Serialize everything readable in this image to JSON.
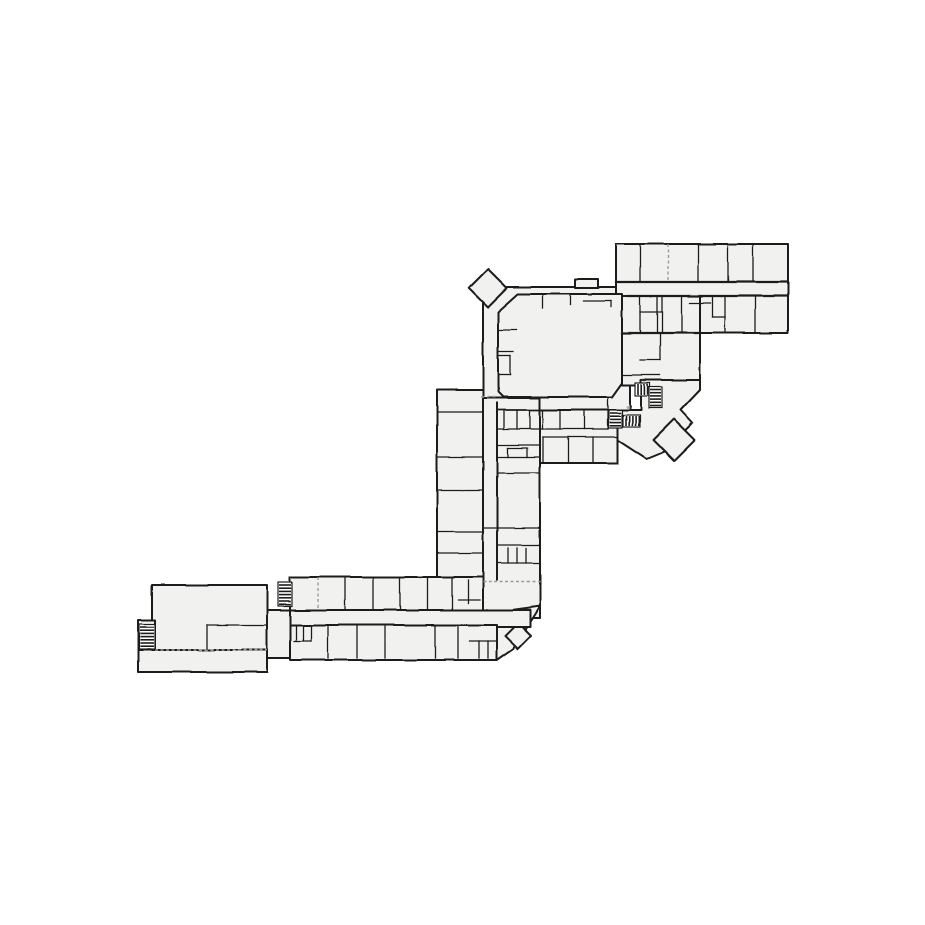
{
  "drawing": {
    "title": "building-floor-plan",
    "canvas": {
      "width": 925,
      "height": 925,
      "background": "#ffffff"
    },
    "style": {
      "room_fill": "#f1f1f0",
      "wall_color": "#1f1f1f",
      "outer_width": 2.0,
      "inner_width": 1.3,
      "dash_color": "#9a9a9a",
      "label_color": "#444444"
    },
    "blocks": [
      {
        "name": "hall-block",
        "points": [
          [
            483,
            287
          ],
          [
            630,
            287
          ],
          [
            630,
            412
          ],
          [
            483,
            412
          ]
        ]
      },
      {
        "name": "hall-top-bump",
        "points": [
          [
            575,
            279
          ],
          [
            598,
            279
          ],
          [
            598,
            288
          ],
          [
            575,
            288
          ]
        ]
      },
      {
        "name": "entry-vestibule",
        "points": [
          [
            488,
            269
          ],
          [
            507,
            288
          ],
          [
            488,
            307
          ],
          [
            469,
            288
          ]
        ]
      },
      {
        "name": "top-right-wing",
        "points": [
          [
            616,
            244
          ],
          [
            788,
            244
          ],
          [
            788,
            333
          ],
          [
            616,
            333
          ]
        ]
      },
      {
        "name": "right-mid-block",
        "points": [
          [
            622,
            296
          ],
          [
            700,
            296
          ],
          [
            700,
            385
          ],
          [
            622,
            385
          ]
        ]
      },
      {
        "name": "lobby",
        "points": [
          [
            604,
            410
          ],
          [
            641,
            410
          ],
          [
            641,
            380
          ],
          [
            700,
            380
          ],
          [
            700,
            390
          ],
          [
            681,
            410
          ],
          [
            693,
            423
          ],
          [
            664,
            452
          ],
          [
            647,
            459
          ],
          [
            604,
            431
          ]
        ]
      },
      {
        "name": "lobby-diamond-room",
        "points": [
          [
            674,
            419
          ],
          [
            695,
            440
          ],
          [
            674,
            461
          ],
          [
            653,
            440
          ]
        ]
      },
      {
        "name": "rooms-below-hall",
        "points": [
          [
            497,
            410
          ],
          [
            618,
            410
          ],
          [
            618,
            463
          ],
          [
            497,
            463
          ]
        ]
      },
      {
        "name": "mid-left-room-column",
        "points": [
          [
            437,
            390
          ],
          [
            483,
            390
          ],
          [
            483,
            577
          ],
          [
            437,
            577
          ]
        ]
      },
      {
        "name": "mid-corridor-block",
        "points": [
          [
            483,
            398
          ],
          [
            540,
            398
          ],
          [
            540,
            618
          ],
          [
            483,
            618
          ]
        ]
      },
      {
        "name": "south-junction",
        "points": [
          [
            483,
            614
          ],
          [
            540,
            606
          ],
          [
            513,
            649
          ],
          [
            497,
            660
          ],
          [
            483,
            660
          ]
        ]
      },
      {
        "name": "junction-diamond-room",
        "points": [
          [
            518,
            623
          ],
          [
            531,
            636
          ],
          [
            518,
            649
          ],
          [
            505,
            636
          ]
        ]
      },
      {
        "name": "southwest-upper-row",
        "points": [
          [
            290,
            577
          ],
          [
            483,
            577
          ],
          [
            483,
            612
          ],
          [
            290,
            612
          ]
        ]
      },
      {
        "name": "southwest-corridor",
        "points": [
          [
            267,
            610
          ],
          [
            530,
            610
          ],
          [
            530,
            627
          ],
          [
            267,
            627
          ]
        ]
      },
      {
        "name": "southwest-lower-row",
        "points": [
          [
            290,
            625
          ],
          [
            497,
            625
          ],
          [
            497,
            660
          ],
          [
            290,
            660
          ]
        ]
      },
      {
        "name": "west-passage",
        "points": [
          [
            267,
            610
          ],
          [
            290,
            610
          ],
          [
            290,
            658
          ],
          [
            267,
            658
          ]
        ]
      },
      {
        "name": "west-large-room",
        "points": [
          [
            152,
            585
          ],
          [
            267,
            585
          ],
          [
            267,
            650
          ],
          [
            152,
            650
          ]
        ]
      },
      {
        "name": "west-lower-strip",
        "points": [
          [
            138,
            650
          ],
          [
            267,
            650
          ],
          [
            267,
            672
          ],
          [
            138,
            672
          ]
        ]
      },
      {
        "name": "west-stair-bay",
        "points": [
          [
            138,
            620
          ],
          [
            155,
            620
          ],
          [
            155,
            650
          ],
          [
            138,
            650
          ]
        ]
      },
      {
        "name": "hall-room",
        "points": [
          [
            498,
            312
          ],
          [
            518,
            294
          ],
          [
            622,
            294
          ],
          [
            622,
            383
          ],
          [
            612,
            397
          ],
          [
            503,
            397
          ],
          [
            498,
            392
          ]
        ]
      }
    ],
    "walls": [
      [
        616,
        282,
        788,
        282,
        2.2
      ],
      [
        628,
        296,
        788,
        296,
        2.2
      ],
      [
        622,
        333,
        700,
        333,
        2.2
      ],
      [
        497,
        403,
        497,
        580,
        2.0
      ],
      [
        640,
        244,
        640,
        282
      ],
      [
        698,
        244,
        698,
        282
      ],
      [
        728,
        244,
        728,
        282
      ],
      [
        753,
        244,
        753,
        282
      ],
      [
        657,
        296,
        657,
        333
      ],
      [
        682,
        296,
        682,
        333
      ],
      [
        712,
        296,
        712,
        317
      ],
      [
        712,
        317,
        725,
        317
      ],
      [
        725,
        296,
        725,
        333
      ],
      [
        755,
        296,
        755,
        333
      ],
      [
        690,
        303,
        710,
        303
      ],
      [
        640,
        296,
        640,
        333
      ],
      [
        662,
        296,
        662,
        333
      ],
      [
        640,
        312,
        662,
        312
      ],
      [
        640,
        360,
        660,
        360
      ],
      [
        660,
        333,
        660,
        360
      ],
      [
        622,
        375,
        660,
        375
      ],
      [
        641,
        385,
        641,
        410
      ],
      [
        543,
        294,
        543,
        308
      ],
      [
        570,
        294,
        570,
        305
      ],
      [
        583,
        301,
        611,
        301
      ],
      [
        611,
        301,
        611,
        307
      ],
      [
        498,
        330,
        516,
        330
      ],
      [
        498,
        352,
        513,
        352
      ],
      [
        498,
        356,
        510,
        356
      ],
      [
        510,
        356,
        510,
        375
      ],
      [
        498,
        375,
        510,
        375
      ],
      [
        437,
        412,
        483,
        412
      ],
      [
        437,
        457,
        483,
        457
      ],
      [
        437,
        490,
        483,
        490
      ],
      [
        437,
        532,
        483,
        532
      ],
      [
        437,
        553,
        483,
        553
      ],
      [
        497,
        445,
        540,
        445
      ],
      [
        508,
        448,
        508,
        457
      ],
      [
        527,
        448,
        527,
        457
      ],
      [
        508,
        448,
        527,
        448
      ],
      [
        497,
        457,
        540,
        457
      ],
      [
        497,
        473,
        540,
        473
      ],
      [
        483,
        528,
        540,
        528
      ],
      [
        497,
        545,
        540,
        545
      ],
      [
        508,
        548,
        508,
        563
      ],
      [
        517,
        548,
        517,
        563
      ],
      [
        526,
        548,
        526,
        563
      ],
      [
        497,
        563,
        540,
        563
      ],
      [
        497,
        410,
        608,
        410,
        1.8
      ],
      [
        497,
        429,
        608,
        429
      ],
      [
        504,
        410,
        504,
        429
      ],
      [
        517,
        410,
        517,
        429
      ],
      [
        530,
        410,
        530,
        429
      ],
      [
        543,
        410,
        543,
        429
      ],
      [
        560,
        410,
        560,
        429
      ],
      [
        584,
        410,
        584,
        429
      ],
      [
        608,
        398,
        608,
        429
      ],
      [
        543,
        437,
        618,
        437
      ],
      [
        543,
        463,
        618,
        463
      ],
      [
        543,
        437,
        543,
        463
      ],
      [
        568,
        437,
        568,
        463
      ],
      [
        593,
        437,
        593,
        463
      ],
      [
        618,
        437,
        618,
        463
      ],
      [
        345,
        577,
        345,
        610
      ],
      [
        373,
        577,
        373,
        610
      ],
      [
        400,
        577,
        400,
        610
      ],
      [
        428,
        577,
        428,
        610
      ],
      [
        452,
        577,
        452,
        610
      ],
      [
        468,
        580,
        468,
        603
      ],
      [
        458,
        600,
        480,
        600
      ],
      [
        328,
        625,
        328,
        658
      ],
      [
        357,
        625,
        357,
        658
      ],
      [
        385,
        625,
        385,
        658
      ],
      [
        435,
        625,
        435,
        658
      ],
      [
        458,
        625,
        458,
        658
      ],
      [
        296,
        625,
        296,
        641
      ],
      [
        303,
        625,
        303,
        641
      ],
      [
        311,
        625,
        311,
        641
      ],
      [
        294,
        641,
        311,
        641
      ],
      [
        470,
        641,
        497,
        641
      ],
      [
        479,
        641,
        479,
        658
      ],
      [
        488,
        641,
        488,
        658
      ],
      [
        207,
        625,
        207,
        650
      ],
      [
        207,
        625,
        267,
        625
      ],
      [
        267,
        585,
        267,
        618
      ]
    ],
    "dashed_walls": [
      [
        668,
        244,
        668,
        282
      ],
      [
        481,
        397,
        497,
        397
      ],
      [
        318,
        577,
        318,
        610
      ],
      [
        483,
        582,
        540,
        582
      ],
      [
        155,
        650,
        267,
        650
      ]
    ],
    "stairs": [
      {
        "name": "stair-west",
        "x": 139,
        "y": 624,
        "w": 16,
        "h": 25,
        "dir": "h"
      },
      {
        "name": "stair-southwest",
        "x": 278,
        "y": 582,
        "w": 14,
        "h": 24,
        "dir": "h"
      },
      {
        "name": "stair-lobby-lower-a",
        "x": 609,
        "y": 410,
        "w": 13,
        "h": 18,
        "dir": "h"
      },
      {
        "name": "stair-lobby-lower-b",
        "x": 623,
        "y": 415,
        "w": 17,
        "h": 12,
        "dir": "v"
      },
      {
        "name": "stair-lobby-upper-a",
        "x": 635,
        "y": 383,
        "w": 15,
        "h": 13,
        "dir": "v"
      },
      {
        "name": "stair-lobby-upper-b",
        "x": 649,
        "y": 387,
        "w": 13,
        "h": 21,
        "dir": "h"
      }
    ],
    "labels": [
      {
        "name": "stair-up-label-lower",
        "x": 626,
        "y": 408,
        "text": "up"
      },
      {
        "name": "stair-up-label-upper",
        "x": 641,
        "y": 381,
        "text": "up"
      }
    ]
  }
}
